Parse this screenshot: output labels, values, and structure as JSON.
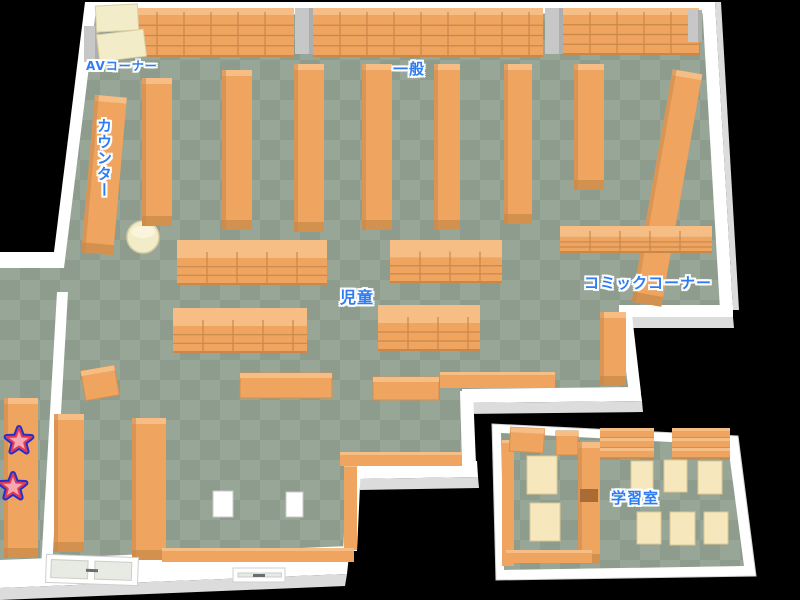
{
  "map": {
    "labels": {
      "av": {
        "text": "AVコーナー"
      },
      "general": {
        "text": "一般"
      },
      "counter": {
        "text": "カウンター"
      },
      "children": {
        "text": "児童"
      },
      "comic": {
        "text": "コミックコーナー"
      },
      "study": {
        "text": "学習室"
      }
    },
    "markers": {
      "stars": [
        {
          "x": 19,
          "y": 441
        },
        {
          "x": 13,
          "y": 487
        }
      ]
    },
    "colors": {
      "background": "#000000",
      "floor_light": "#98a698",
      "floor_dark": "#8e9c8e",
      "shelf": "#efa460",
      "shelf_top": "#f6bd85",
      "shelf_dark": "#d2914e",
      "shelf_edge": "#c9884a",
      "shelf_line": "#c9884a",
      "cream": "#f3ecc9",
      "cream_edge": "#d9cfa2",
      "desk": "#f6e7bd",
      "desk_edge": "#dcc793",
      "wall": "#ffffff",
      "wall_shade": "#dcdcdc",
      "label_blue": "#2e7cf2",
      "star_pink": "#f6a8b2",
      "star_red": "#e23a52",
      "star_blue": "#2330cc"
    },
    "furniture": [
      {
        "t": "grid",
        "x": 130,
        "y": 8,
        "w": 164,
        "h": 48
      },
      {
        "t": "grid",
        "x": 313,
        "y": 8,
        "w": 230,
        "h": 48
      },
      {
        "t": "grid",
        "x": 563,
        "y": 8,
        "w": 136,
        "h": 46
      },
      {
        "t": "pillar",
        "x": 295,
        "y": 8,
        "w": 18,
        "h": 46
      },
      {
        "t": "pillar",
        "x": 545,
        "y": 8,
        "w": 18,
        "h": 46
      },
      {
        "t": "pillar",
        "x": 84,
        "y": 26,
        "w": 15,
        "h": 36
      },
      {
        "t": "pillar",
        "x": 688,
        "y": 10,
        "w": 14,
        "h": 32
      },
      {
        "t": "cream",
        "x": 96,
        "y": 5,
        "w": 42,
        "h": 26,
        "r": -3
      },
      {
        "t": "cream",
        "x": 98,
        "y": 32,
        "w": 47,
        "h": 27,
        "r": -7
      },
      {
        "t": "counter",
        "x": 88,
        "y": 96,
        "w": 32,
        "h": 158,
        "r": 5
      },
      {
        "t": "cyl",
        "x": 143,
        "y": 237,
        "w": 16
      },
      {
        "t": "vshelf",
        "x": 142,
        "y": 78,
        "w": 30,
        "h": 148
      },
      {
        "t": "vshelf",
        "x": 222,
        "y": 70,
        "w": 30,
        "h": 160
      },
      {
        "t": "vshelf",
        "x": 294,
        "y": 64,
        "w": 30,
        "h": 168
      },
      {
        "t": "vshelf",
        "x": 362,
        "y": 64,
        "w": 30,
        "h": 166
      },
      {
        "t": "vshelf",
        "x": 434,
        "y": 64,
        "w": 26,
        "h": 166
      },
      {
        "t": "vshelf",
        "x": 504,
        "y": 64,
        "w": 28,
        "h": 160
      },
      {
        "t": "vshelf",
        "x": 574,
        "y": 64,
        "w": 30,
        "h": 126
      },
      {
        "t": "vshelf",
        "x": 652,
        "y": 70,
        "w": 30,
        "h": 236,
        "r": 10
      },
      {
        "t": "vshelf",
        "x": 600,
        "y": 312,
        "w": 26,
        "h": 74
      },
      {
        "t": "hshelf",
        "x": 177,
        "y": 240,
        "w": 150,
        "h": 44
      },
      {
        "t": "hshelf",
        "x": 390,
        "y": 240,
        "w": 112,
        "h": 42
      },
      {
        "t": "hshelf",
        "x": 560,
        "y": 226,
        "w": 152,
        "h": 26
      },
      {
        "t": "hshelf",
        "x": 173,
        "y": 308,
        "w": 134,
        "h": 44
      },
      {
        "t": "hshelf",
        "x": 378,
        "y": 305,
        "w": 102,
        "h": 45
      },
      {
        "t": "table",
        "x": 240,
        "y": 373,
        "w": 92,
        "h": 25
      },
      {
        "t": "table",
        "x": 373,
        "y": 377,
        "w": 66,
        "h": 23
      },
      {
        "t": "strip",
        "x": 440,
        "y": 372,
        "w": 115,
        "h": 16
      },
      {
        "t": "table",
        "x": 83,
        "y": 368,
        "w": 34,
        "h": 30,
        "r": -10
      },
      {
        "t": "vshelf",
        "x": 4,
        "y": 398,
        "w": 34,
        "h": 160
      },
      {
        "t": "vshelf",
        "x": 54,
        "y": 414,
        "w": 30,
        "h": 138
      },
      {
        "t": "vshelf",
        "x": 132,
        "y": 418,
        "w": 34,
        "h": 142
      },
      {
        "t": "strip",
        "x": 344,
        "y": 464,
        "w": 13,
        "h": 86
      },
      {
        "t": "strip",
        "x": 340,
        "y": 452,
        "w": 122,
        "h": 14
      },
      {
        "t": "strip",
        "x": 162,
        "y": 548,
        "w": 192,
        "h": 14
      },
      {
        "t": "box",
        "x": 213,
        "y": 491,
        "w": 20,
        "h": 26
      },
      {
        "t": "box",
        "x": 286,
        "y": 492,
        "w": 17,
        "h": 25
      },
      {
        "t": "strip",
        "x": 502,
        "y": 440,
        "w": 12,
        "h": 126
      },
      {
        "t": "table",
        "x": 510,
        "y": 428,
        "w": 34,
        "h": 24,
        "r": 3
      },
      {
        "t": "table",
        "x": 556,
        "y": 431,
        "w": 22,
        "h": 24
      },
      {
        "t": "vshelf",
        "x": 578,
        "y": 442,
        "w": 22,
        "h": 122
      },
      {
        "t": "notch",
        "x": 580,
        "y": 489,
        "w": 18,
        "h": 13
      },
      {
        "t": "step",
        "x": 600,
        "y": 428,
        "w": 54,
        "h": 30
      },
      {
        "t": "step",
        "x": 672,
        "y": 428,
        "w": 58,
        "h": 30
      },
      {
        "t": "desk",
        "x": 527,
        "y": 456,
        "w": 30,
        "h": 38
      },
      {
        "t": "desk",
        "x": 530,
        "y": 503,
        "w": 30,
        "h": 38
      },
      {
        "t": "desk",
        "x": 631,
        "y": 461,
        "w": 22,
        "h": 33
      },
      {
        "t": "desk",
        "x": 664,
        "y": 460,
        "w": 23,
        "h": 32
      },
      {
        "t": "desk",
        "x": 698,
        "y": 461,
        "w": 24,
        "h": 33
      },
      {
        "t": "desk",
        "x": 637,
        "y": 512,
        "w": 24,
        "h": 32
      },
      {
        "t": "desk",
        "x": 670,
        "y": 512,
        "w": 25,
        "h": 33
      },
      {
        "t": "desk",
        "x": 704,
        "y": 512,
        "w": 24,
        "h": 32
      },
      {
        "t": "strip",
        "x": 506,
        "y": 550,
        "w": 86,
        "h": 13
      },
      {
        "t": "door",
        "x": 46,
        "y": 556,
        "w": 92,
        "h": 28,
        "r": 2
      },
      {
        "t": "door",
        "x": 233,
        "y": 568,
        "w": 52,
        "h": 14
      }
    ]
  }
}
